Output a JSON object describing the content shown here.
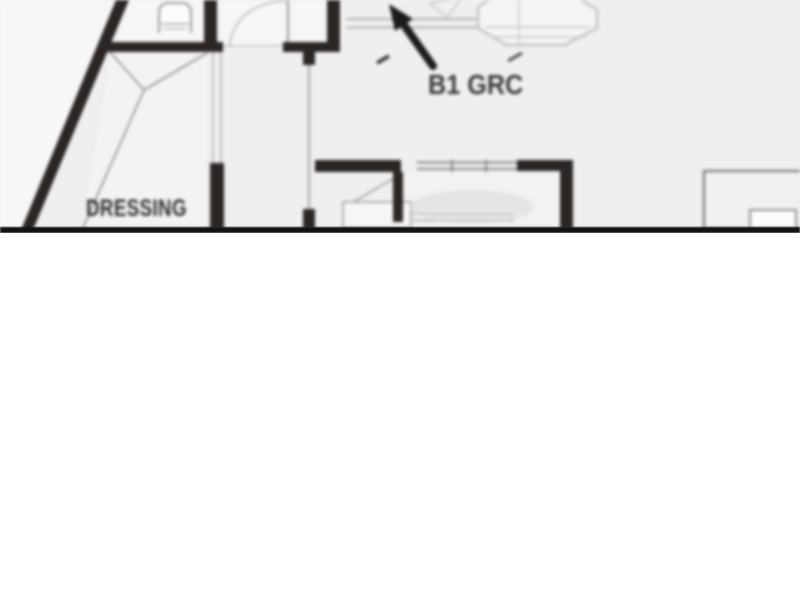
{
  "floorplan": {
    "room_label": "DRESSING",
    "annotation_label": "B1 GRC",
    "annotation_arrow_icon": "arrow-pointing-up-left",
    "colors": {
      "plan_background": "#efefef",
      "outside_background": "#f7f7f7",
      "wall": "#2b2524",
      "thin_line": "#8f8f8f",
      "light_furniture_line": "#c4c4c4",
      "arrow": "#1d1b1a",
      "label_text": "#2f2d2c",
      "divider_line": "#121212",
      "page_background": "#ffffff"
    }
  }
}
